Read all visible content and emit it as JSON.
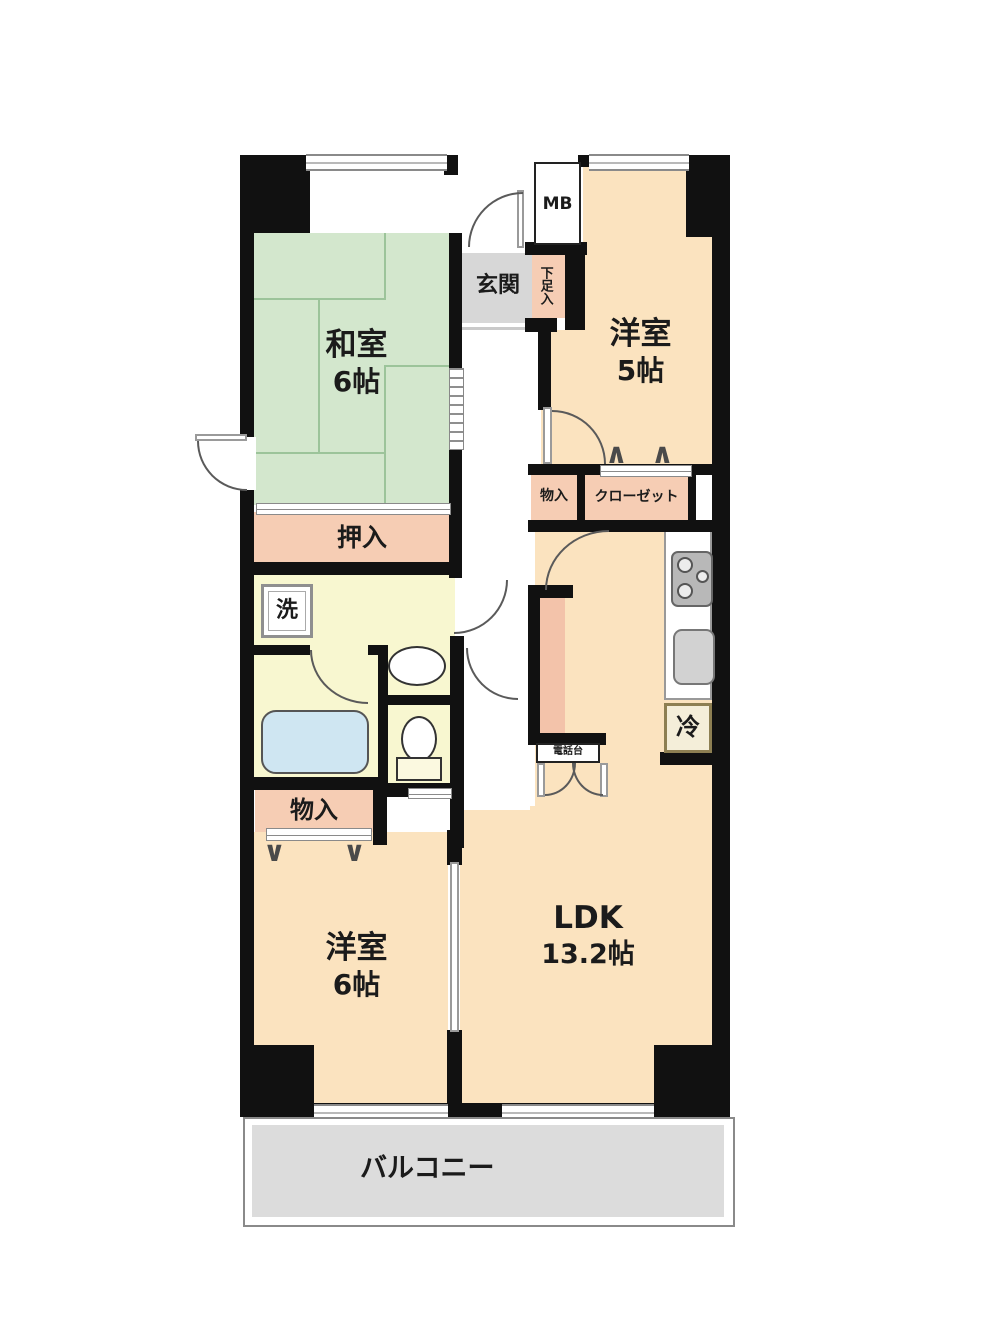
{
  "rooms": {
    "washitsu": {
      "name": "和室",
      "size": "6帖"
    },
    "youshitsu5": {
      "name": "洋室",
      "size": "5帖"
    },
    "youshitsu6": {
      "name": "洋室",
      "size": "6帖"
    },
    "ldk": {
      "name": "LDK",
      "size": "13.2帖"
    },
    "genkan": {
      "name": "玄関"
    },
    "balcony": {
      "name": "バルコニー"
    }
  },
  "fixtures": {
    "mb": "MB",
    "getabako": "下足入",
    "oshiire": "押入",
    "monoire_upper": "物入",
    "closet": "クローゼット",
    "washer": "洗",
    "fridge": "冷",
    "phone_stand": "電話台",
    "monoire_lower": "物入"
  },
  "symbols": {
    "bifold_up": "∧",
    "bifold_down": "∨"
  },
  "colors": {
    "wall": "#111111",
    "room_floor": "#fbe3bf",
    "tatami": "#d3e7cd",
    "tatami_line": "#9cc49a",
    "closet_fill": "#f6cdb4",
    "wet_area": "#f8f7d0",
    "entry": "#d7d7d7",
    "balcony": "#dcdcdc",
    "bathtub": "#cfe6f2",
    "counter": "#f3c3aa"
  }
}
